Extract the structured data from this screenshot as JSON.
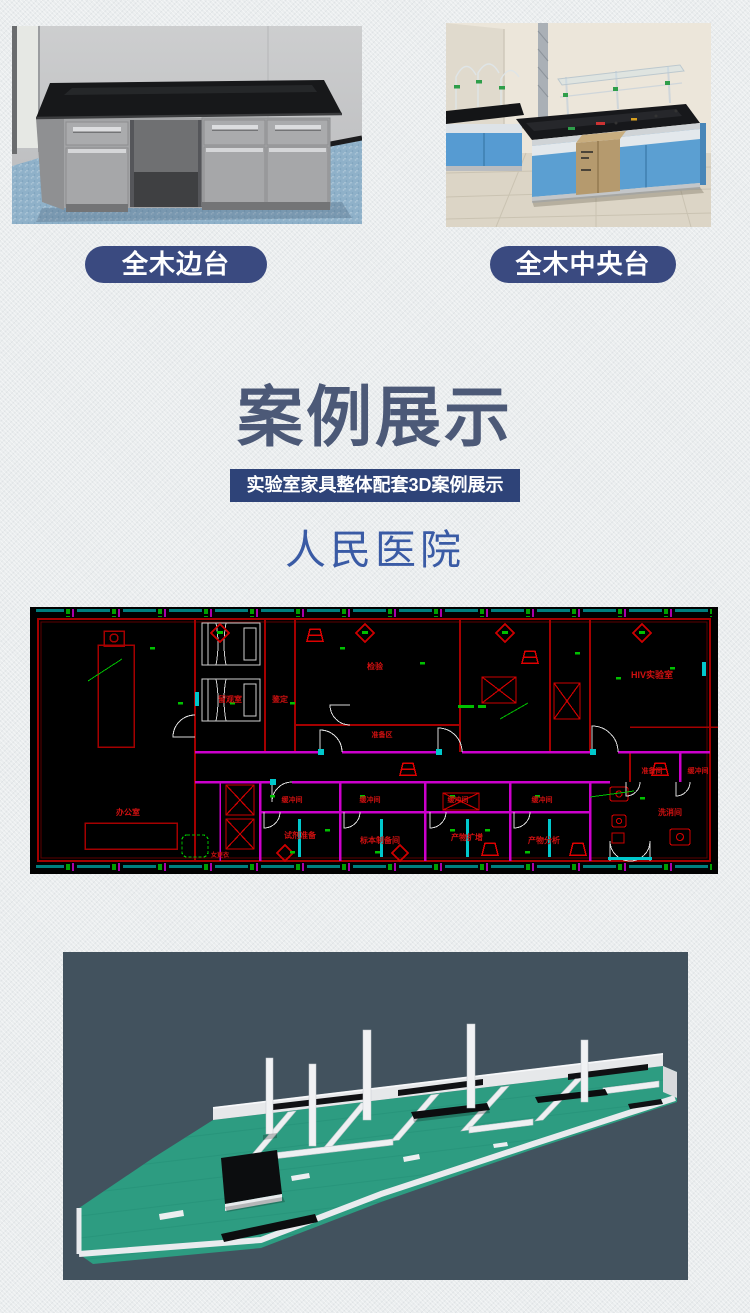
{
  "products": [
    {
      "label": "全木边台"
    },
    {
      "label": "全木中央台"
    }
  ],
  "section": {
    "title": "案例展示",
    "subtitle": "实验室家具整体配套3D案例展示",
    "case_name": "人民医院"
  },
  "colors": {
    "badge_navy": "#3a4a80",
    "title_slate": "#4c5977",
    "subtitle_bar_navy": "#2e4378",
    "case_blue": "#3a5ba5",
    "cad_background": "#000000",
    "cad_wall_red": "#a50000",
    "cad_wall_magenta": "#cc00cc",
    "cad_accent_cyan": "#00c8cc",
    "cad_dim_green": "#00c000",
    "cad_label_red": "#d01010",
    "render_background": "#42525e",
    "render_floor_teal": "#2d9c81"
  },
  "cad": {
    "rooms": [
      {
        "label": "留观室"
      },
      {
        "label": "鉴定"
      },
      {
        "label": "检验"
      },
      {
        "label": "准备区"
      },
      {
        "label": "HIV实验室"
      },
      {
        "label": "办公室"
      },
      {
        "label": "试剂准备"
      },
      {
        "label": "标本制备间"
      },
      {
        "label": "产物扩增"
      },
      {
        "label": "产物分析"
      },
      {
        "label": "准备间"
      },
      {
        "label": "洗消间"
      },
      {
        "label": "女更衣"
      }
    ],
    "buffer_label": "缓冲间"
  }
}
